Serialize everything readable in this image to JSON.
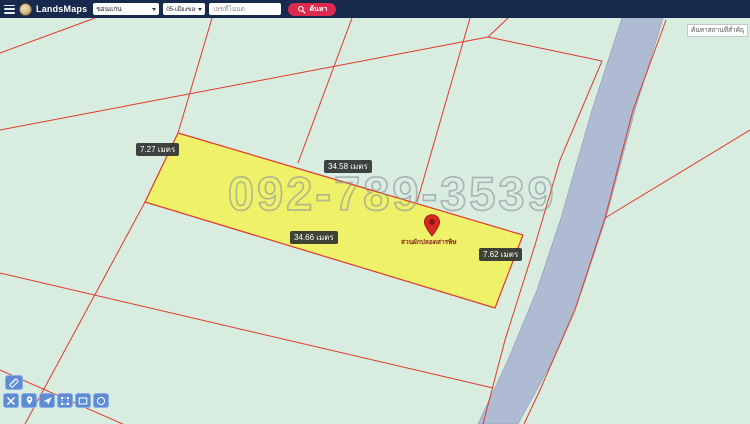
{
  "topbar": {
    "title": "LandsMaps",
    "province_select": "ขอนแก่น",
    "district_select": "05-เมืองขอนแก่น",
    "deed_input_placeholder": "เลขที่โฉนด",
    "search_button_label": "ค้นหา"
  },
  "map": {
    "poi_search_placeholder": "ค้นหาสถานที่สำคัญ",
    "watermark_phone": "092-789-3539",
    "marker_label": "สวนผักปลอดสารพิษ",
    "measurements": {
      "west": "7.27 เมตร",
      "north": "34.58 เมตร",
      "south": "34.66 เมตร",
      "east": "7.62 เมตร"
    },
    "colors": {
      "map_background": "#d8ede0",
      "parcel_fill": "#f1f25e",
      "parcel_boundary": "#e0392c",
      "river": "#afbad3",
      "topbar": "#17294d",
      "search_button": "#dc2a4e",
      "toolbar_blue": "#5687d4",
      "marker_red": "#d42a20"
    }
  },
  "toolbar": {
    "buttons": [
      "measure",
      "clear",
      "drop-marker",
      "navigate",
      "draw-polygon",
      "draw-rectangle",
      "draw-circle"
    ]
  }
}
